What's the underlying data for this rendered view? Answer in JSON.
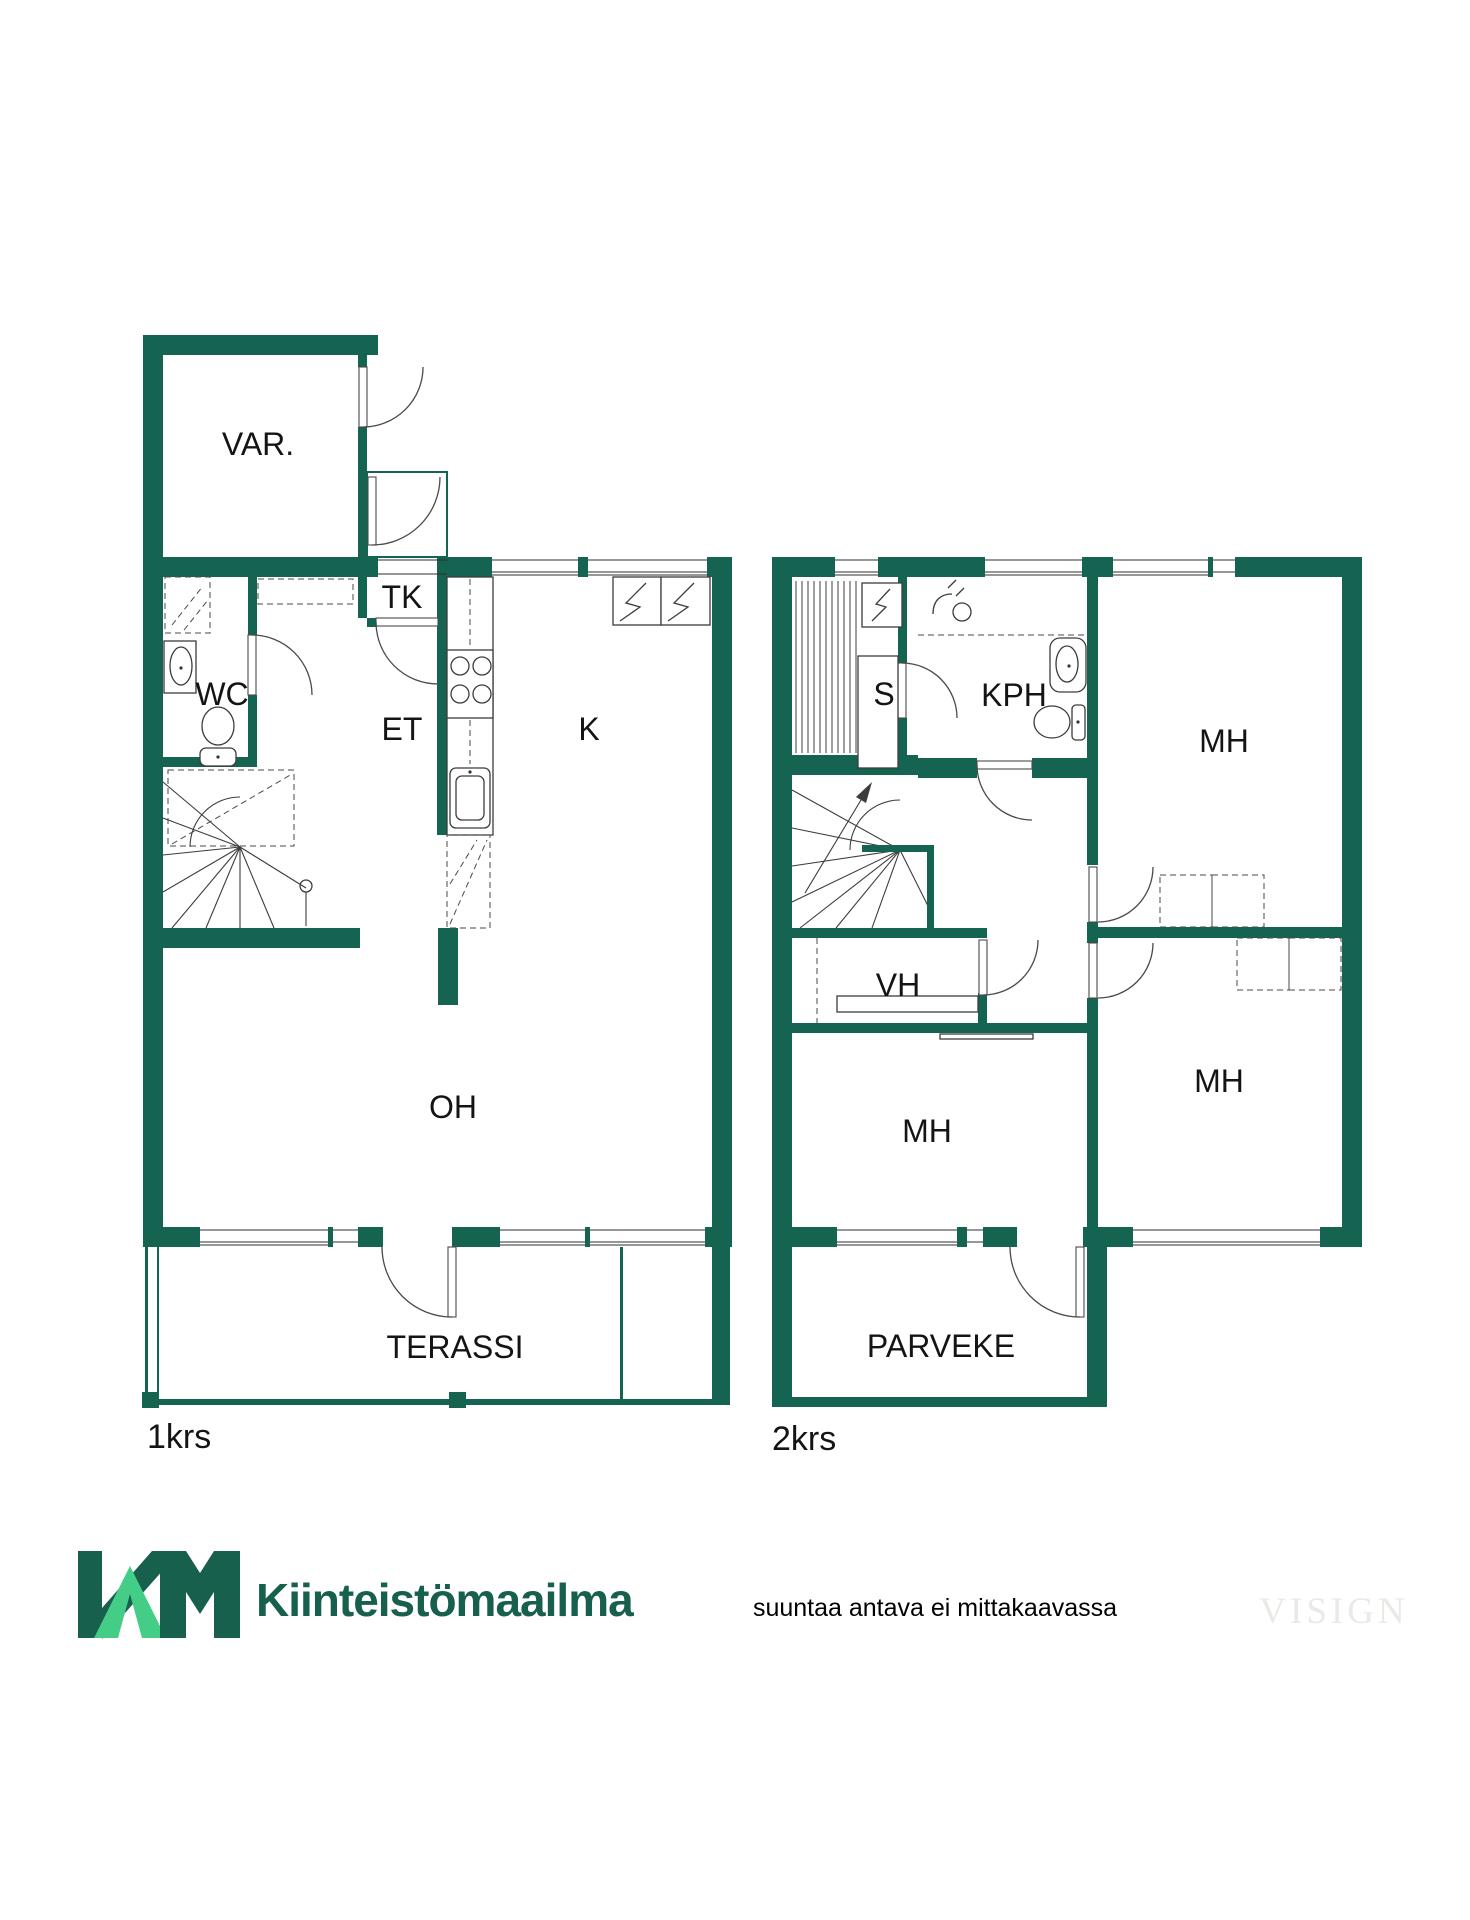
{
  "floor1": {
    "label": "1krs",
    "rooms": {
      "var": "VAR.",
      "tk": "TK",
      "wc": "WC",
      "et": "ET",
      "k": "K",
      "oh": "OH",
      "terassi": "TERASSI"
    }
  },
  "floor2": {
    "label": "2krs",
    "rooms": {
      "s": "S",
      "kph": "KPH",
      "mh_right_top": "MH",
      "vh": "VH",
      "mh_middle": "MH",
      "mh_right_bottom": "MH",
      "parveke": "PARVEKE"
    }
  },
  "footer": {
    "brand": "Kiinteistömaailma",
    "disclaimer": "suuntaa antava ei mittakaavassa",
    "watermark": "VISIGN"
  },
  "colors": {
    "wall_green": "#156351",
    "logo_dark": "#17604e",
    "logo_light": "#44cd86",
    "watermark_gray": "#e9e9e5"
  }
}
